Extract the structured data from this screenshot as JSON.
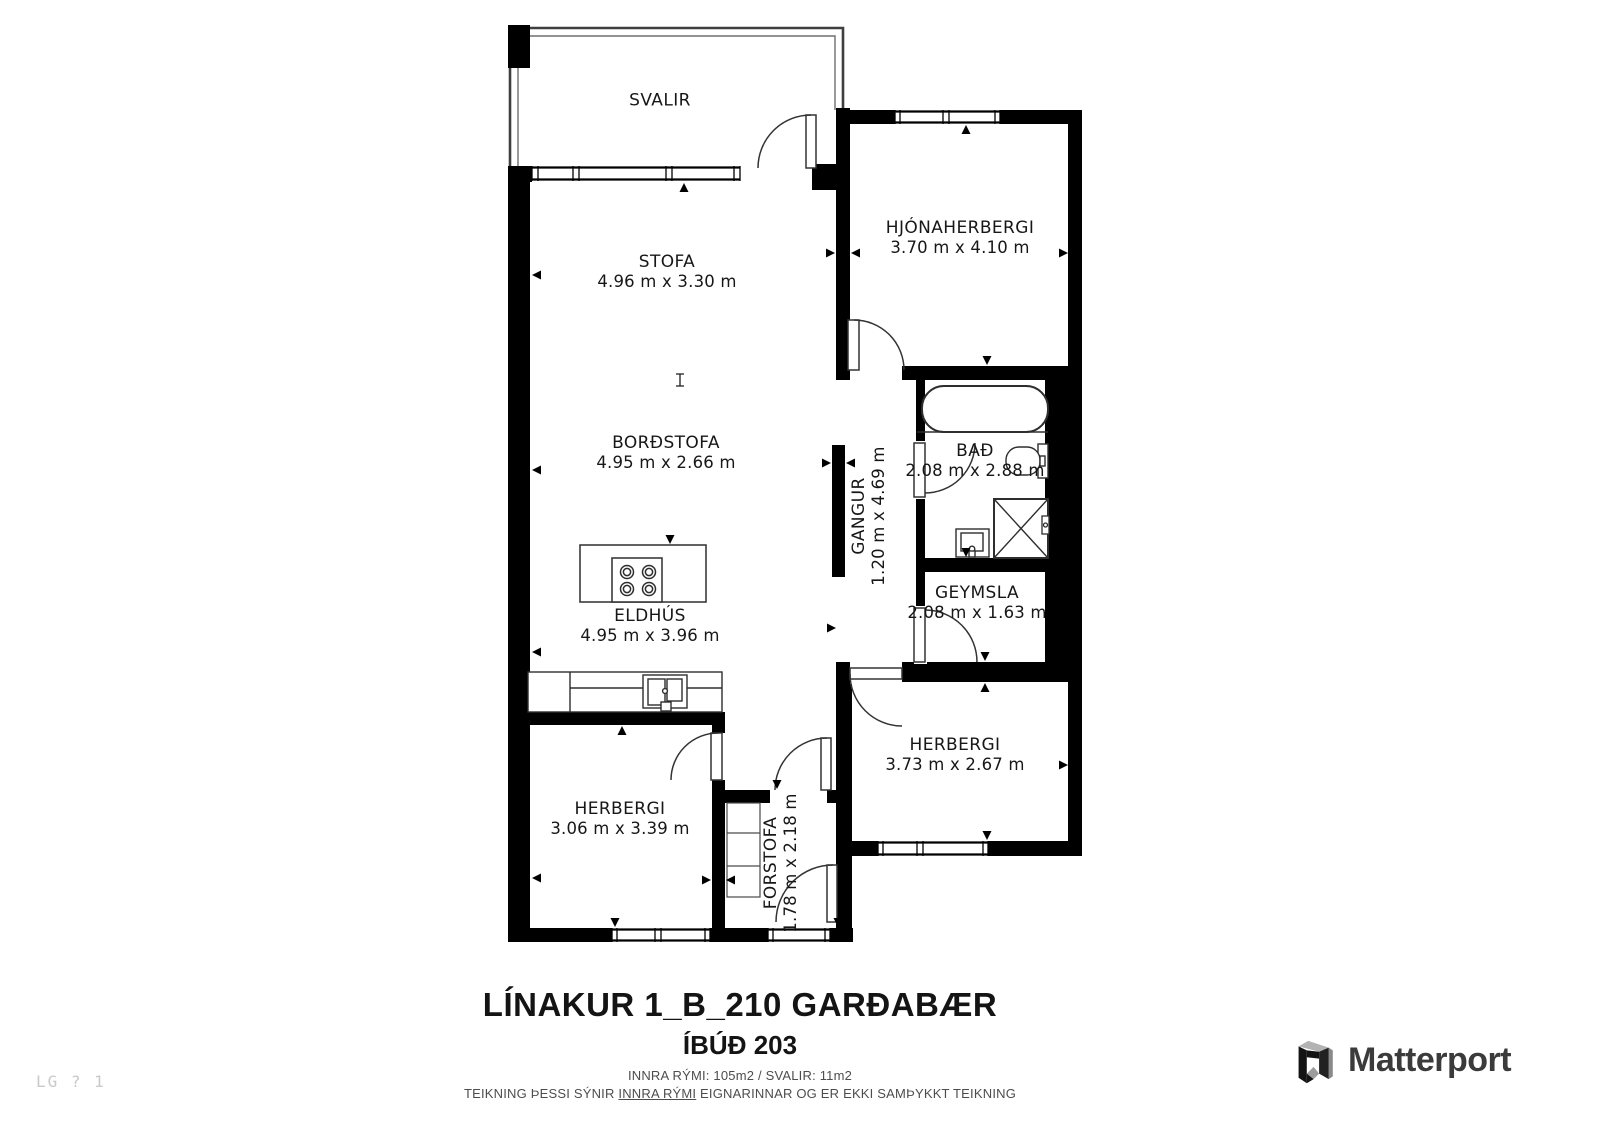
{
  "rooms": [
    {
      "name": "SVALIR",
      "dims": ""
    },
    {
      "name": "STOFA",
      "dims": "4.96 m x 3.30 m"
    },
    {
      "name": "HJÓNAHERBERGI",
      "dims": "3.70 m x 4.10 m"
    },
    {
      "name": "BORÐSTOFA",
      "dims": "4.95 m x 2.66 m"
    },
    {
      "name": "GANGUR",
      "dims": "1.20 m x 4.69 m"
    },
    {
      "name": "BAÐ",
      "dims": "2.08 m x 2.88 m"
    },
    {
      "name": "GEYMSLA",
      "dims": "2.08 m x 1.63 m"
    },
    {
      "name": "ELDHÚS",
      "dims": "4.95 m x 3.96 m"
    },
    {
      "name": "HERBERGI",
      "dims": "3.73 m x 2.67 m"
    },
    {
      "name": "HERBERGI",
      "dims": "3.06 m x 3.39 m"
    },
    {
      "name": "FORSTOFA",
      "dims": "1.78 m x 2.18 m"
    }
  ],
  "footer": {
    "title": "LÍNAKUR 1_B_210 GARÐABÆR",
    "subtitle": "ÍBÚÐ 203",
    "area_line": "INNRA RÝMI: 105m2  /  SVALIR: 11m2",
    "disclaimer": {
      "before": "TEIKNING ÞESSI SÝNIR ",
      "underlined": "INNRA RÝMI",
      "after": " EIGNARINNAR OG ER EKKI SAMÞYKKT TEIKNING"
    }
  },
  "watermark": "LG ? 1",
  "logo": {
    "text": "Matterport"
  },
  "colors": {
    "wall": "#000000",
    "fixture_line": "#2e2e2e",
    "logo_text": "#3b3b3b",
    "faint": "#c9c9c9"
  }
}
